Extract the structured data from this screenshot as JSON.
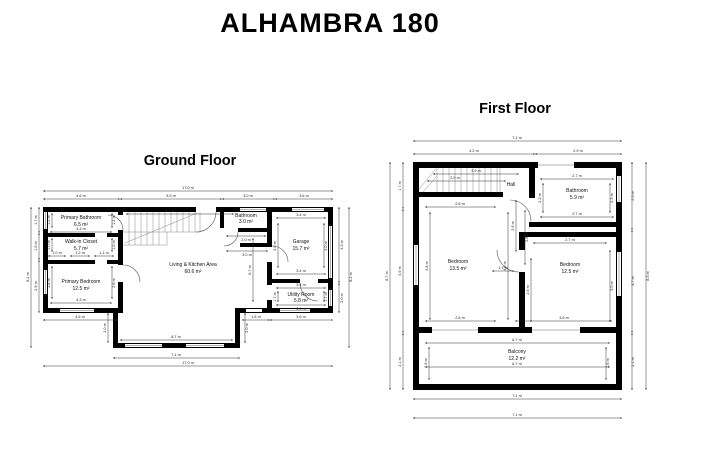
{
  "title": "ALHAMBRA 180",
  "ground_floor": {
    "title": "Ground Floor",
    "rooms": {
      "primary_bathroom": {
        "name": "Primary Bathroom",
        "area": "6.5 m²"
      },
      "walk_in_closet": {
        "name": "Walk-in Closet",
        "area": "5.7 m²"
      },
      "primary_bedroom": {
        "name": "Primary Bedroom",
        "area": "12.5 m²"
      },
      "living_kitchen": {
        "name": "Living & Kitchen Area",
        "area": "60.6 m²"
      },
      "bathroom": {
        "name": "Bathroom",
        "area": "3.0 m²"
      },
      "garage": {
        "name": "Garage",
        "area": "15.7 m²"
      },
      "utility_room": {
        "name": "Utility Room",
        "area": "5.8 m²"
      }
    },
    "dims": {
      "total_width_top": "17.0 m",
      "total_width_bottom": "17.0 m",
      "top_seg1": "4.6 m",
      "top_seg2": "5.9 m",
      "top_seg3": "3.0 m",
      "top_seg4": "3.6 m",
      "left_total": "8.2 m",
      "left_seg1": "1.7 m",
      "left_seg2": "1.6 m",
      "left_seg3": "2.9 m",
      "right_seg1": "4.3 m",
      "right_seg2": "2.0 m",
      "right_total": "8.2 m",
      "bottom_seg1": "4.6 m",
      "bottom_seg2": "1.8 m",
      "bottom_seg3": "3.6 m",
      "bump_outer": "7.1 m",
      "bump_inner": "8.7 m",
      "bump_side_left": "2.0 m",
      "bump_side_right": "2.0 m",
      "living_width": "6.7 m",
      "living_height": "6.7 m",
      "pbath_width": "4.3 m",
      "pbath_side": "1.2 m",
      "closet_seg1": "1.0 m",
      "closet_seg2": "1.2 m",
      "closet_seg3": "1.1 m",
      "closet_side": "1.0 m",
      "pbed_width": "4.3 m",
      "pbed_side": "2.8 m",
      "bath_width": "2.0 m",
      "bath_width2": "3.0 m",
      "garage_width_top": "3.4 m",
      "garage_width_bottom": "3.4 m",
      "garage_side": "4.0 m",
      "utility_width_top": "3.4 m",
      "utility_width_bottom": "3.4 m",
      "utility_side": "1.7 m"
    }
  },
  "first_floor": {
    "title": "First Floor",
    "rooms": {
      "hall": {
        "name": "Hall"
      },
      "bathroom": {
        "name": "Bathroom",
        "area": "5.9 m²"
      },
      "bedroom_left": {
        "name": "Bedroom",
        "area": "13.5 m²"
      },
      "bedroom_right": {
        "name": "Bedroom",
        "area": "12.5 m²"
      },
      "balcony": {
        "name": "Balcony",
        "area": "12.2 m²"
      }
    },
    "dims": {
      "total_width_top": "7.1 m",
      "total_width_bottom1": "7.1 m",
      "total_width_bottom2": "7.1 m",
      "top_seg1": "4.2 m",
      "top_seg2": "2.9 m",
      "left_seg1": "1.7 m",
      "left_seg2": "4.9 m",
      "left_seg3": "2.1 m",
      "left_total": "8.7 m",
      "right_seg1": "2.5 m",
      "right_seg2": "3.7 m",
      "right_seg3": "2.1 m",
      "right_total": "8.3 m",
      "stairs_dim1": "3.9 m",
      "stairs_dim2": "2.9 m",
      "hall_v1": "2.9 m",
      "hall_v2": "2.8 m",
      "door": "1.1 m",
      "bedl_top": "2.6 m",
      "bedl_bottom": "2.6 m",
      "bedl_side": "4.8 m",
      "bath_top": "2.7 m",
      "bath_bottom": "2.7 m",
      "bath_side_l": "2.2 m",
      "bath_side_r": "2.3 m",
      "bedr_top": "2.7 m",
      "bedr_bottom": "3.6 m",
      "bedr_side_l": "2.9 m",
      "bedr_side_r": "3.5 m",
      "balcony_top": "6.7 m",
      "balcony_bottom": "6.7 m",
      "balcony_side": "1.6 m"
    }
  }
}
